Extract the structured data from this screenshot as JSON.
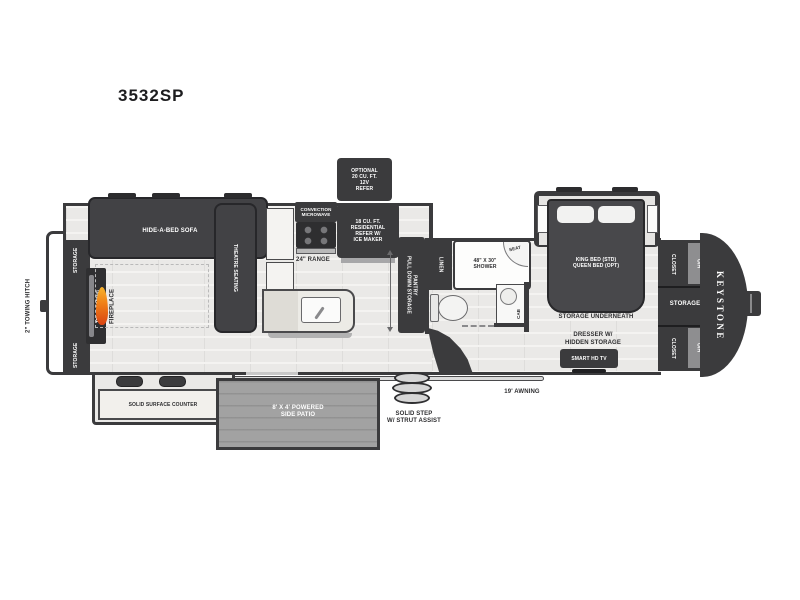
{
  "title": "3532SP",
  "brand": "KEYSTONE",
  "colors": {
    "wall_dark": "#3b3b3d",
    "floor": "#eae9e7",
    "flame_accent": "#ef7d17",
    "patio_gray": "#a2a2a2"
  },
  "rear": {
    "towing_hitch": "2\" TOWING HITCH",
    "storage_top": "STORAGE",
    "storage_bottom": "STORAGE",
    "telescoping_tv": "TELESCOPING\nSMART HDTV",
    "fireplace": "FIREPLACE"
  },
  "living": {
    "sofa": "HIDE-A-BED SOFA",
    "theatre_seating": "THEATRE SEATING",
    "solid_surface_counter": "SOLID SURFACE COUNTER"
  },
  "kitchen": {
    "convection_microwave": "CONVECTION\nMICROWAVE",
    "range": "24\" RANGE",
    "optional_refer": "OPTIONAL\n20 CU. FT.\n12V\nREFER",
    "residential_refer": "18 CU. FT.\nRESIDENTIAL\nREFER W/\nICE MAKER",
    "pantry": "PULL DOWN STORAGE\nPANTRY"
  },
  "bath": {
    "linen": "LINEN",
    "shower": "48\" X 30\"\nSHOWER",
    "seat": "SEAT",
    "cab": "CAB"
  },
  "bedroom": {
    "bed": "KING BED (STD)\nQUEEN BED (OPT)",
    "storage_underneath": "STORAGE UNDERNEATH",
    "dresser": "DRESSER W/\nHIDDEN STORAGE",
    "tv": "SMART HD TV",
    "closet_top": "CLOSET",
    "oh_top": "O/H",
    "storage_mid": "STORAGE",
    "closet_bottom": "CLOSET",
    "oh_bottom": "O/H"
  },
  "exterior": {
    "side_patio": "8' X 4' POWERED\nSIDE PATIO",
    "solid_step": "SOLID STEP\nW/ STRUT ASSIST",
    "awning": "19' AWNING"
  }
}
